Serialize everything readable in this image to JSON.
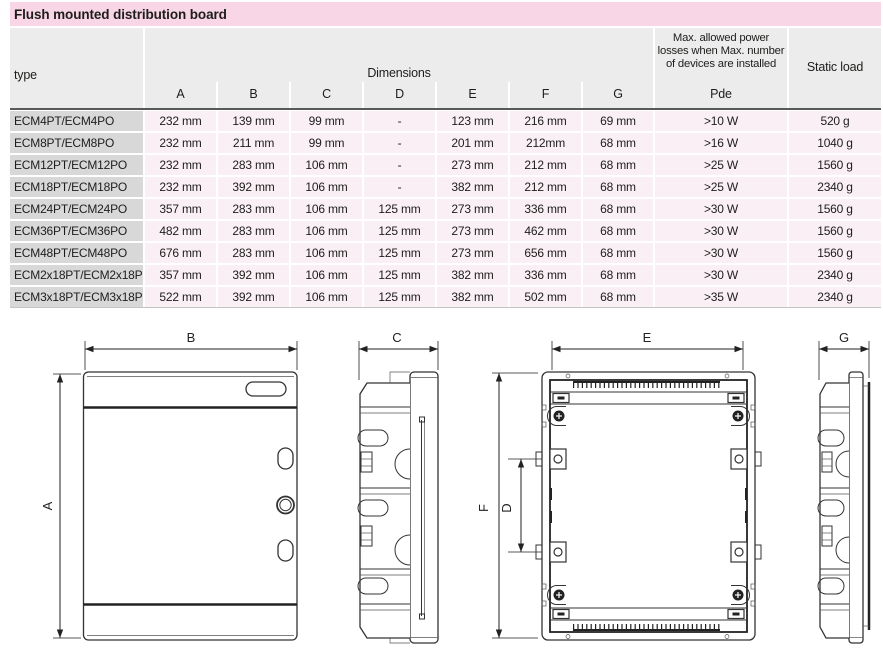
{
  "title": "Flush mounted distribution board",
  "table": {
    "col_type": "type",
    "dimensions_label": "Dimensions",
    "dim_columns": [
      "A",
      "B",
      "C",
      "D",
      "E",
      "F",
      "G"
    ],
    "pde_header_lines": [
      "Max. allowed power",
      "losses when Max. number",
      "of devices are installed"
    ],
    "pde_label": "Pde",
    "static_load_label": "Static load",
    "rows": [
      {
        "type": "ECM4PT/ECM4PO",
        "a": "232 mm",
        "b": "139 mm",
        "c": "99 mm",
        "d": "-",
        "e": "123 mm",
        "f": "216 mm",
        "g": "69 mm",
        "pde": ">10 W",
        "static": "520 g"
      },
      {
        "type": "ECM8PT/ECM8PO",
        "a": "232 mm",
        "b": "211 mm",
        "c": "99 mm",
        "d": "-",
        "e": "201 mm",
        "f": "212mm",
        "g": "68 mm",
        "pde": ">16 W",
        "static": "1040 g"
      },
      {
        "type": "ECM12PT/ECM12PO",
        "a": "232 mm",
        "b": "283 mm",
        "c": "106 mm",
        "d": "-",
        "e": "273 mm",
        "f": "212 mm",
        "g": "68 mm",
        "pde": ">25 W",
        "static": "1560 g"
      },
      {
        "type": "ECM18PT/ECM18PO",
        "a": "232 mm",
        "b": "392 mm",
        "c": "106 mm",
        "d": "-",
        "e": "382 mm",
        "f": "212 mm",
        "g": "68 mm",
        "pde": ">25 W",
        "static": "2340 g"
      },
      {
        "type": "ECM24PT/ECM24PO",
        "a": "357 mm",
        "b": "283 mm",
        "c": "106 mm",
        "d": "125 mm",
        "e": "273 mm",
        "f": "336 mm",
        "g": "68 mm",
        "pde": ">30 W",
        "static": "1560 g"
      },
      {
        "type": "ECM36PT/ECM36PO",
        "a": "482 mm",
        "b": "283 mm",
        "c": "106 mm",
        "d": "125 mm",
        "e": "273 mm",
        "f": "462 mm",
        "g": "68 mm",
        "pde": ">30 W",
        "static": "1560 g"
      },
      {
        "type": "ECM48PT/ECM48PO",
        "a": "676 mm",
        "b": "283 mm",
        "c": "106 mm",
        "d": "125 mm",
        "e": "273 mm",
        "f": "656 mm",
        "g": "68 mm",
        "pde": ">30 W",
        "static": "1560 g"
      },
      {
        "type": "ECM2x18PT/ECM2x18PO",
        "a": "357 mm",
        "b": "392 mm",
        "c": "106 mm",
        "d": "125 mm",
        "e": "382 mm",
        "f": "336 mm",
        "g": "68 mm",
        "pde": ">30 W",
        "static": "2340 g"
      },
      {
        "type": "ECM3x18PT/ECM3x18PO",
        "a": "522 mm",
        "b": "392 mm",
        "c": "106 mm",
        "d": "125 mm",
        "e": "382 mm",
        "f": "502 mm",
        "g": "68 mm",
        "pde": ">35 W",
        "static": "2340 g"
      }
    ]
  },
  "drawings": {
    "front_view": {
      "width_label": "B",
      "height_label": "A"
    },
    "side_view_c": {
      "depth_label": "C"
    },
    "rear_view": {
      "width_label": "E",
      "height_label": "F",
      "fixing_label": "D"
    },
    "side_view_g": {
      "depth_label": "G"
    }
  },
  "colors": {
    "title_bg": "#F8D6E5",
    "header_bg": "#ECECEC",
    "type_cell_bg": "#D8D8D9",
    "data_cell_bg": "#FAEFF5",
    "header_rule": "#58595B",
    "text": "#1D1D1B"
  }
}
